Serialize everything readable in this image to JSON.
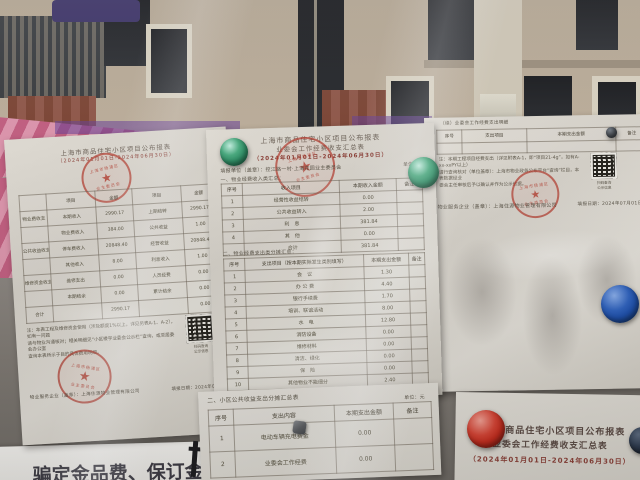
{
  "palette": {
    "paper": "#d9d5cc",
    "paper_bright": "#e6e3dd",
    "stamp_red": "#b23e32",
    "magnet_green": "#2e8a63",
    "magnet_blue": "#1e4fa8",
    "magnet_red": "#c22a1c",
    "ink": "#4c463d",
    "title_red": "#8a4038",
    "wall_reflection": "#b4a692"
  },
  "left_doc": {
    "title": "上海市商品住宅小区项目公布报表",
    "subtitle": "（2024年01月01日-2024年06月30日）",
    "table": {
      "head": [
        "",
        "项目",
        "金额",
        "项目",
        "金额"
      ],
      "rows": [
        [
          "物业费收支",
          "本期收入",
          "2990.17",
          "上期结转",
          "2990.17"
        ],
        [
          "",
          "物业费收入",
          "384.00",
          "公共收益",
          "1.00"
        ],
        [
          "公共收益收支",
          "停车费收入",
          "20848.40",
          "经营收益",
          "20848.40"
        ],
        [
          "",
          "其他收入",
          "8.00",
          "利息收入",
          "1.00"
        ],
        [
          "维修资金收支",
          "维修支出",
          "0.00",
          "人员经费",
          "0.00"
        ],
        [
          "",
          "本期结余",
          "0.00",
          "累计结余",
          "0.00"
        ],
        [
          "合计",
          "",
          "2990.17",
          "",
          "0.00"
        ]
      ]
    },
    "note_lines": [
      "注：本表工程及维修资金使用（涉及额度1%以上，详见另表A-1、A-2），如有一问题",
      "请与物业沟通核对；相关明细见“小区楼宇业委会公示栏”查询，或至居委会办公室",
      "查询本表所示子目的具体费用明细。"
    ],
    "qr_caption_1": "扫码查询",
    "qr_caption_2": "公示信息",
    "footer_left": "物业服务企业（盖章）：上海住源物业管理有限公司",
    "footer_right": "填报日期：2024年07月01日"
  },
  "middle_doc": {
    "title": "上海市商品住宅小区项目公布报表",
    "subtitle": "业委会工作经费收支汇总表",
    "period": "（2024年01月01日-2024年06月30日）",
    "unit_line": "填报单位（盖章）：控江路一村·上海花园业主委员会",
    "unit_label": "单位：元",
    "section1": "一、物业经费收入类汇总：",
    "income_table": {
      "head": [
        "序号",
        "收入项目",
        "本期收入金额",
        "备注"
      ],
      "rows": [
        [
          "1",
          "经营性收益结转",
          "0.00",
          ""
        ],
        [
          "2",
          "公共收益转入",
          "2.00",
          ""
        ],
        [
          "3",
          "利　息",
          "381.84",
          ""
        ],
        [
          "4",
          "其　他",
          "0.00",
          ""
        ],
        [
          "",
          "合计",
          "381.84",
          ""
        ]
      ]
    },
    "section2": "二、物业经费支出类分摊汇总：",
    "expense_table": {
      "head": [
        "序号",
        "支出项目（按本期实际发生类别填写）",
        "本期支出金额",
        "备注"
      ],
      "rows": [
        [
          "1",
          "会　议",
          "1.30",
          ""
        ],
        [
          "2",
          "办 公 费",
          "4.40",
          ""
        ],
        [
          "3",
          "银行手续费",
          "1.70",
          ""
        ],
        [
          "4",
          "培训、联谊活动",
          "8.00",
          ""
        ],
        [
          "5",
          "水　电",
          "12.80",
          ""
        ],
        [
          "6",
          "消防设备",
          "0.00",
          ""
        ],
        [
          "7",
          "维修材料",
          "0.00",
          ""
        ],
        [
          "8",
          "清洁、绿化",
          "0.00",
          ""
        ],
        [
          "9",
          "保　险",
          "0.00",
          ""
        ],
        [
          "10",
          "其他物业不能细分",
          "2.40",
          ""
        ]
      ]
    }
  },
  "bottom_doc": {
    "section": "二、小区公共收益支出分摊汇总表",
    "unit_label": "单位：元",
    "table": {
      "head": [
        "序号",
        "支出内容",
        "本期支出金额",
        "备注"
      ],
      "rows": [
        [
          "1",
          "电动车辆充电费金",
          "0.00",
          ""
        ],
        [
          "2",
          "业委会工作经费",
          "0.00",
          ""
        ]
      ]
    }
  },
  "right_doc": {
    "cont_label": "（续）业委会工作经费支出明细",
    "table": {
      "head": [
        "序号",
        "支出项目",
        "本期支出金额",
        "备注"
      ],
      "rows": [
        [
          "",
          "",
          "",
          ""
        ]
      ]
    },
    "note_lines": [
      "注：本期工程项目经费支出（详见附表A-1，即“项目21-4g”，如有A-xx-xxPY以上）",
      "请行查询核对（单位盖章）：上海市物业政务公布平台“查询”栏目，本表数据经业",
      "委会主任审核后予以确认并作为公示依据。"
    ],
    "qr_caption_1": "扫码查询",
    "qr_caption_2": "公示信息",
    "signer": "物业服务企业（盖章）：上海住源物业管理有限公司",
    "date": "填报日期：2024年07月01日"
  },
  "right_lower_doc": {
    "title": "上海市商品住宅小区项目公布报表",
    "subtitle": "业委会工作经费收支汇总表",
    "period": "（2024年01月01日-2024年06月30日）"
  },
  "sign": {
    "text": "骗定金品费、保订金、体"
  },
  "stamp": {
    "star": "★",
    "ring_top": "上海市杨浦区",
    "ring_bottom": "业主委员会"
  }
}
